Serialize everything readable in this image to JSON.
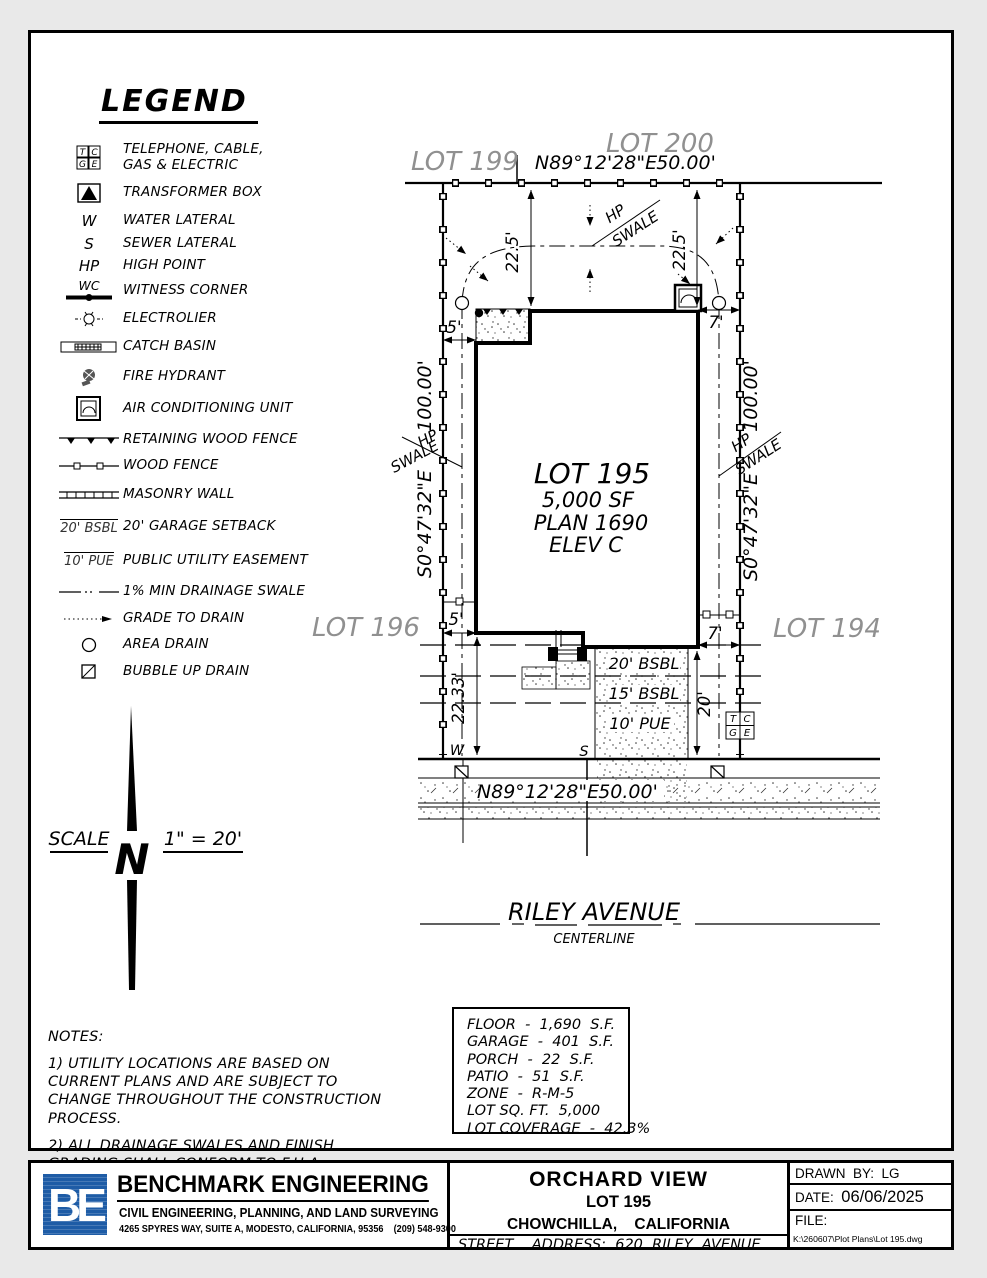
{
  "colors": {
    "ink": "#000000",
    "muted_lot": "#909090",
    "logo_blue": "#1e5ca6",
    "paper": "#ffffff"
  },
  "legend": {
    "title": "LEGEND",
    "items": [
      {
        "name": "telephone-cable-gas-electric",
        "cells": [
          "T",
          "C",
          "G",
          "E"
        ],
        "label": "TELEPHONE, CABLE, GAS & ELECTRIC"
      },
      {
        "name": "transformer-box",
        "label": "TRANSFORMER BOX"
      },
      {
        "name": "water-lateral",
        "symbol_text": "W",
        "label": "WATER LATERAL"
      },
      {
        "name": "sewer-lateral",
        "symbol_text": "S",
        "label": "SEWER LATERAL"
      },
      {
        "name": "high-point",
        "symbol_text": "HP",
        "label": "HIGH POINT"
      },
      {
        "name": "witness-corner",
        "symbol_text": "WC",
        "label": "WITNESS CORNER"
      },
      {
        "name": "electrolier",
        "label": "ELECTROLIER"
      },
      {
        "name": "catch-basin",
        "label": "CATCH BASIN"
      },
      {
        "name": "fire-hydrant",
        "label": "FIRE HYDRANT"
      },
      {
        "name": "air-conditioning-unit",
        "label": "AIR CONDITIONING UNIT"
      },
      {
        "name": "retaining-wood-fence",
        "label": "RETAINING WOOD FENCE"
      },
      {
        "name": "wood-fence",
        "label": "WOOD FENCE"
      },
      {
        "name": "masonry-wall",
        "label": "MASONRY WALL"
      },
      {
        "name": "garage-setback",
        "symbol_text": "20' BSBL",
        "label": "20' GARAGE SETBACK"
      },
      {
        "name": "public-utility-easement",
        "symbol_text": "10' PUE",
        "label": "PUBLIC UTILITY EASEMENT"
      },
      {
        "name": "min-drainage-swale",
        "label": "1% MIN DRAINAGE SWALE"
      },
      {
        "name": "grade-to-drain",
        "label": "GRADE TO DRAIN"
      },
      {
        "name": "area-drain",
        "label": "AREA DRAIN"
      },
      {
        "name": "bubble-up-drain",
        "label": "BUBBLE UP DRAIN"
      }
    ]
  },
  "plan": {
    "lots": {
      "current": "LOT 195",
      "north": "LOT 200",
      "northwest": "LOT 199",
      "west": "LOT 196",
      "east": "LOT 194"
    },
    "lot_info": {
      "area": "5,000 SF",
      "plan": "PLAN 1690",
      "elev": "ELEV C"
    },
    "bearings": {
      "front": "N89°12'28\"E",
      "front_dist": "50.00'",
      "side": "S0°47'32\"E",
      "side_dist": "100.00'"
    },
    "dims": {
      "rear": "22.5'",
      "side_left": "5'",
      "side_right": "7'",
      "front": "22.33'",
      "driveway": "20'"
    },
    "setbacks": {
      "bsbl20": "20' BSBL",
      "bsbl15": "15' BSBL",
      "pue10": "10' PUE"
    },
    "swale": {
      "hp": "HP",
      "swale": "SWALE"
    },
    "utilities": {
      "water": "W",
      "sewer": "S",
      "tcge": [
        "T",
        "C",
        "G",
        "E"
      ]
    },
    "street": {
      "name": "RILEY AVENUE",
      "centerline": "CENTERLINE"
    }
  },
  "scale_bar": {
    "label": "SCALE",
    "value": "1\" = 20'",
    "north": "N"
  },
  "notes": {
    "title": "NOTES:",
    "items": [
      "1) UTILITY LOCATIONS ARE BASED ON CURRENT PLANS AND ARE SUBJECT TO CHANGE THROUGHOUT THE CONSTRUCTION PROCESS.",
      "2) ALL DRAINAGE SWALES AND FINISH GRADING SHALL CONFORM TO F.H.A. STANDARDS."
    ]
  },
  "site_data": {
    "rows": [
      "FLOOR  -  1,690  S.F.",
      "GARAGE  -  401  S.F.",
      "PORCH  -  22  S.F.",
      "PATIO  -  51  S.F.",
      "ZONE  -  R-M-5",
      "LOT SQ. FT.  5,000",
      "LOT COVERAGE  -  42.3%"
    ]
  },
  "title_block": {
    "company": {
      "initials": "BE",
      "name": "BENCHMARK ENGINEERING",
      "tagline": "CIVIL ENGINEERING, PLANNING, AND LAND SURVEYING",
      "address": "4265 SPYRES WAY, SUITE A, MODESTO, CALIFORNIA, 95356    (209) 548-9300"
    },
    "project": {
      "title": "ORCHARD VIEW",
      "lot": "LOT 195",
      "location": "CHOWCHILLA,    CALIFORNIA",
      "street_address": "STREET    ADDRESS:  620  RILEY  AVENUE"
    },
    "meta": {
      "drawn_by_label": "DRAWN  BY:",
      "drawn_by": "LG",
      "date_label": "DATE:",
      "date": "06/06/2025",
      "file_label": "FILE:",
      "file_path": "K:\\260607\\Plot Plans\\Lot 195.dwg"
    }
  }
}
